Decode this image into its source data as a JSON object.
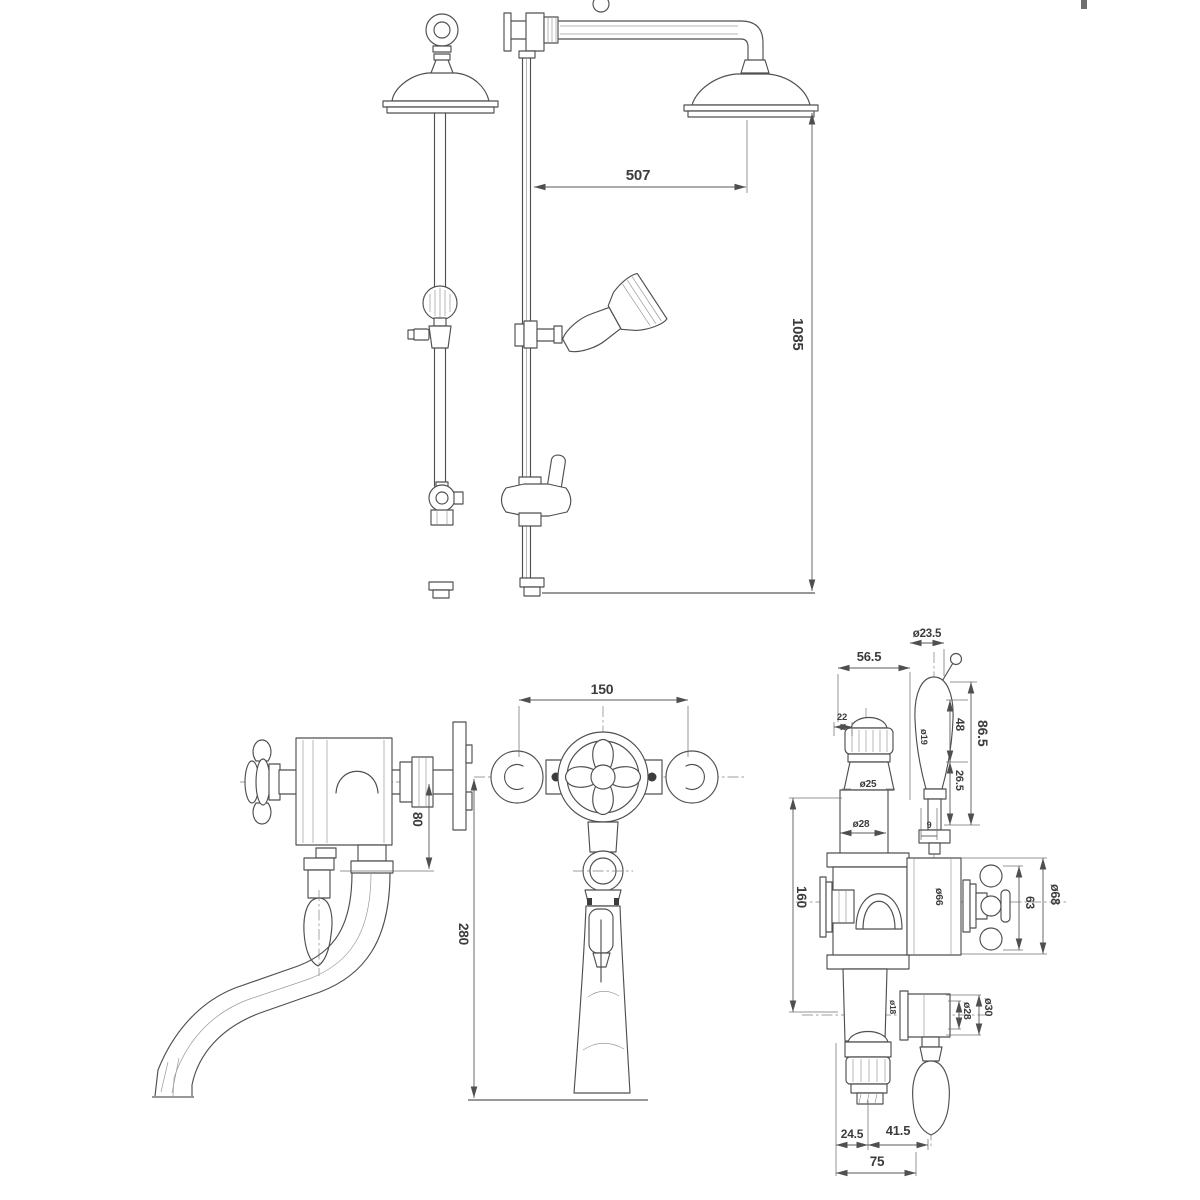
{
  "colors": {
    "background": "#ffffff",
    "line": "#4f4f4f",
    "dimension_line": "#5a5a5a",
    "text": "#3c3c3c"
  },
  "dims": {
    "arm_projection": "507",
    "riser_height": "1085",
    "side_outlet_drop": "80",
    "front_union_centers": "150",
    "front_body_to_handle": "280",
    "top_port_offset": "22",
    "handle_center_offset": "56.5",
    "handle_knob_dia": "ø23.5",
    "handle_grip_dia": "ø19",
    "handle_grip_len": "48",
    "handle_total_len": "86.5",
    "handle_lower_len": "26.5",
    "top_nut_dia": "ø25",
    "top_tube_dia": "ø28",
    "stem_offset": "9",
    "port_spacing": "160",
    "cartridge_dia": "ø66",
    "cross_handle_span": "63",
    "flange_dia": "ø68",
    "outlet_stub_dia": "ø18",
    "outlet_dia": "ø28",
    "outlet_flange_dia": "ø30",
    "base_left": "24.5",
    "base_right": "41.5",
    "base_total": "75"
  }
}
